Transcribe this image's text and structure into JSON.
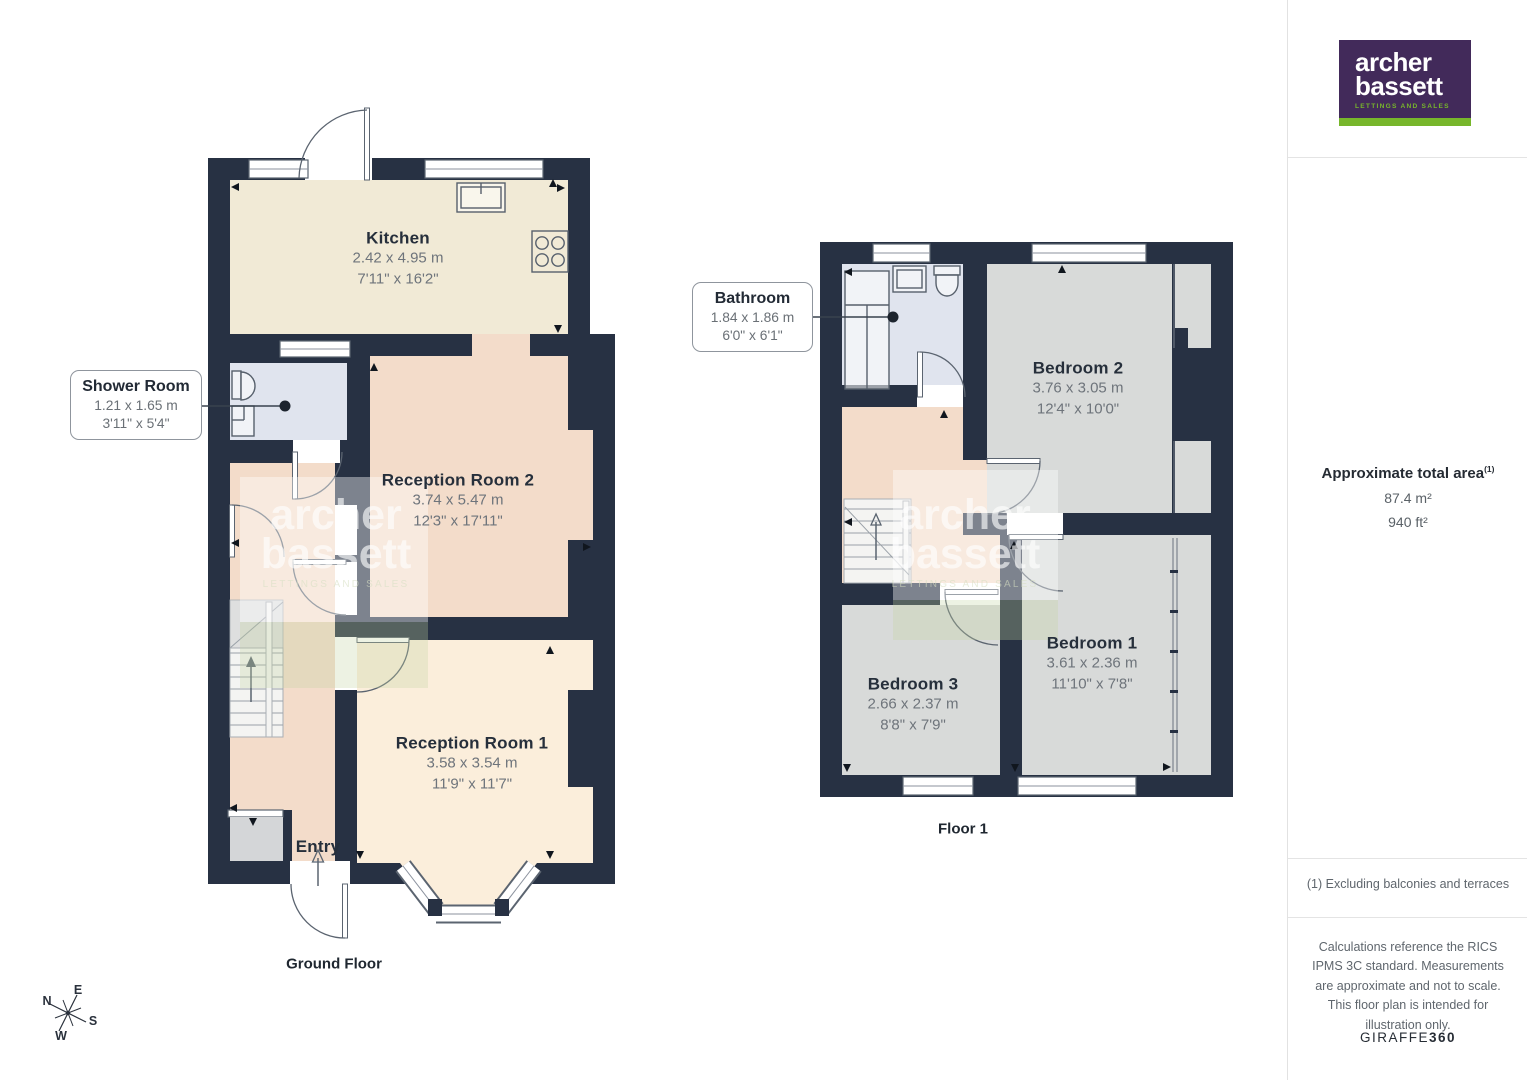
{
  "ground": {
    "floor_label": "Ground Floor",
    "kitchen": {
      "name": "Kitchen",
      "metric": "2.42 x 4.95 m",
      "imperial": "7'11\" x 16'2\""
    },
    "reception2": {
      "name": "Reception Room 2",
      "metric": "3.74 x 5.47 m",
      "imperial": "12'3\" x 17'11\""
    },
    "reception1": {
      "name": "Reception Room 1",
      "metric": "3.58 x 3.54 m",
      "imperial": "11'9\" x 11'7\""
    },
    "entry": {
      "name": "Entry"
    },
    "shower_callout": {
      "name": "Shower Room",
      "metric": "1.21 x 1.65 m",
      "imperial": "3'11\" x 5'4\""
    }
  },
  "first": {
    "floor_label": "Floor 1",
    "bedroom1": {
      "name": "Bedroom 1",
      "metric": "3.61 x 2.36 m",
      "imperial": "11'10\" x 7'8\""
    },
    "bedroom2": {
      "name": "Bedroom 2",
      "metric": "3.76 x 3.05 m",
      "imperial": "12'4\" x 10'0\""
    },
    "bedroom3": {
      "name": "Bedroom 3",
      "metric": "2.66 x 2.37 m",
      "imperial": "8'8\" x 7'9\""
    },
    "bathroom_callout": {
      "name": "Bathroom",
      "metric": "1.84 x 1.86 m",
      "imperial": "6'0\" x 6'1\""
    }
  },
  "compass": {
    "n": "N",
    "e": "E",
    "s": "S",
    "w": "W"
  },
  "watermark": {
    "line1": "archer",
    "line2": "bassett",
    "tagline": "LETTINGS AND SALES"
  },
  "sidebar": {
    "logo": {
      "word1": "archer",
      "word2": "bassett",
      "tagline": "LETTINGS AND SALES"
    },
    "area_title": "Approximate total area",
    "area_sup": "(1)",
    "area_metric": "87.4 m²",
    "area_imperial": "940 ft²",
    "footnote": "(1) Excluding balconies and terraces",
    "disclaimer": "Calculations reference the RICS IPMS 3C standard. Measurements are approximate and not to scale. This floor plan is intended for illustration only.",
    "brand_name": "GIRAFFE",
    "brand_suffix": "360"
  },
  "colors": {
    "wall": "#273143",
    "kitchen_floor": "#f1ead6",
    "reception1_floor": "#fbeedb",
    "salmon_floor": "#f3dcca",
    "bath_floor": "#e0e4ee",
    "bedroom_floor": "#d8dad9",
    "porch_floor": "#d4d6d8",
    "logo_purple": "#422a5a",
    "logo_green": "#77b62b"
  }
}
